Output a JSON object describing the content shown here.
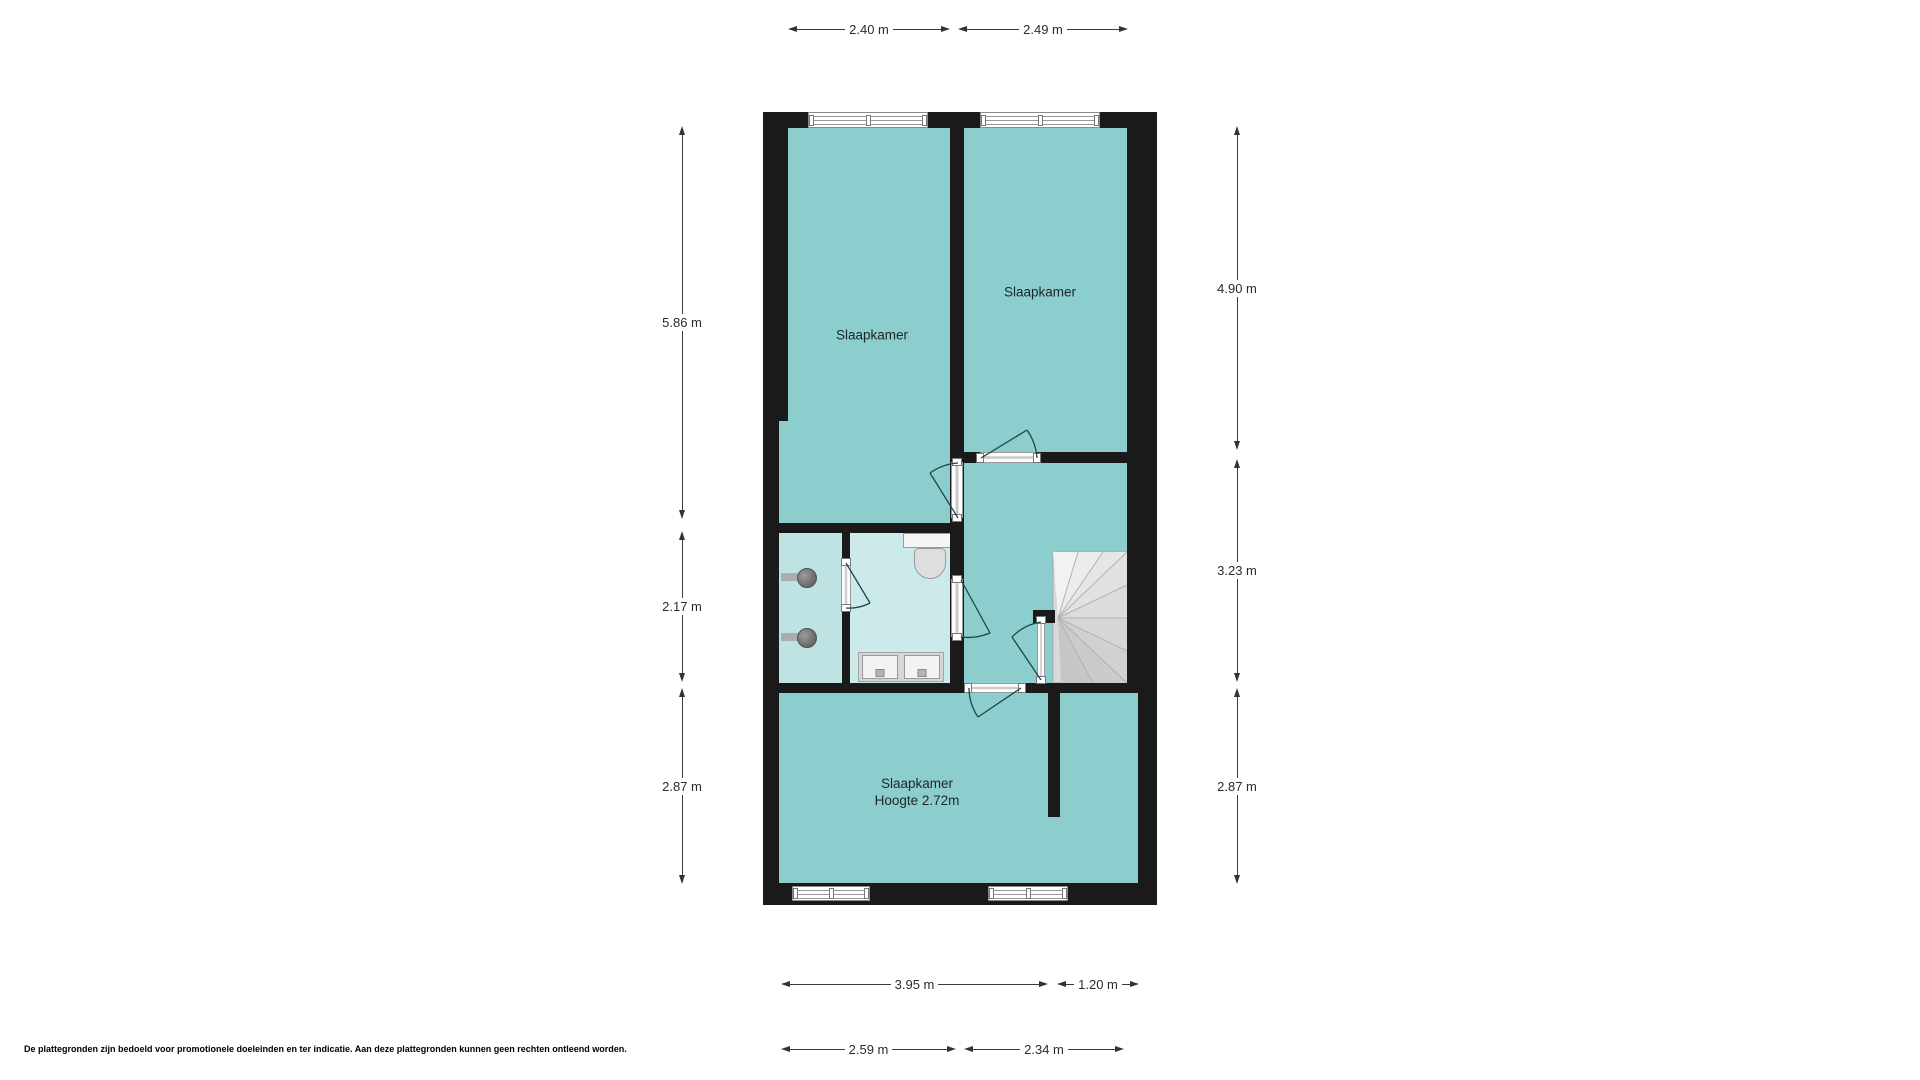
{
  "floorplan": {
    "rooms": [
      {
        "id": "bedroom-1",
        "label": "Slaapkamer"
      },
      {
        "id": "bedroom-2",
        "label": "Slaapkamer"
      },
      {
        "id": "bedroom-3",
        "label": "Slaapkamer",
        "sublabel": "Hoogte 2.72m"
      }
    ],
    "dimensions": {
      "top": [
        {
          "label": "2.40 m"
        },
        {
          "label": "2.49 m"
        }
      ],
      "left": [
        {
          "label": "5.86 m"
        },
        {
          "label": "2.17 m"
        },
        {
          "label": "2.87 m"
        }
      ],
      "right": [
        {
          "label": "4.90 m"
        },
        {
          "label": "3.23 m"
        },
        {
          "label": "2.87 m"
        }
      ],
      "bottom_row1": [
        {
          "label": "3.95 m"
        },
        {
          "label": "1.20 m"
        }
      ],
      "bottom_row2": [
        {
          "label": "2.59 m"
        },
        {
          "label": "2.34 m"
        }
      ]
    },
    "colors": {
      "wall": "#1a1a1a",
      "room_teal": "#8ccecd",
      "bathroom_light": "#cbeae9",
      "bathroom_left": "#bee3e2",
      "stairs_gray": "#dcdcdc",
      "door_arc": "#1d4746"
    },
    "disclaimer": "De plattegronden zijn bedoeld voor promotionele doeleinden en ter indicatie. Aan deze plattegronden kunnen geen rechten ontleend worden."
  }
}
